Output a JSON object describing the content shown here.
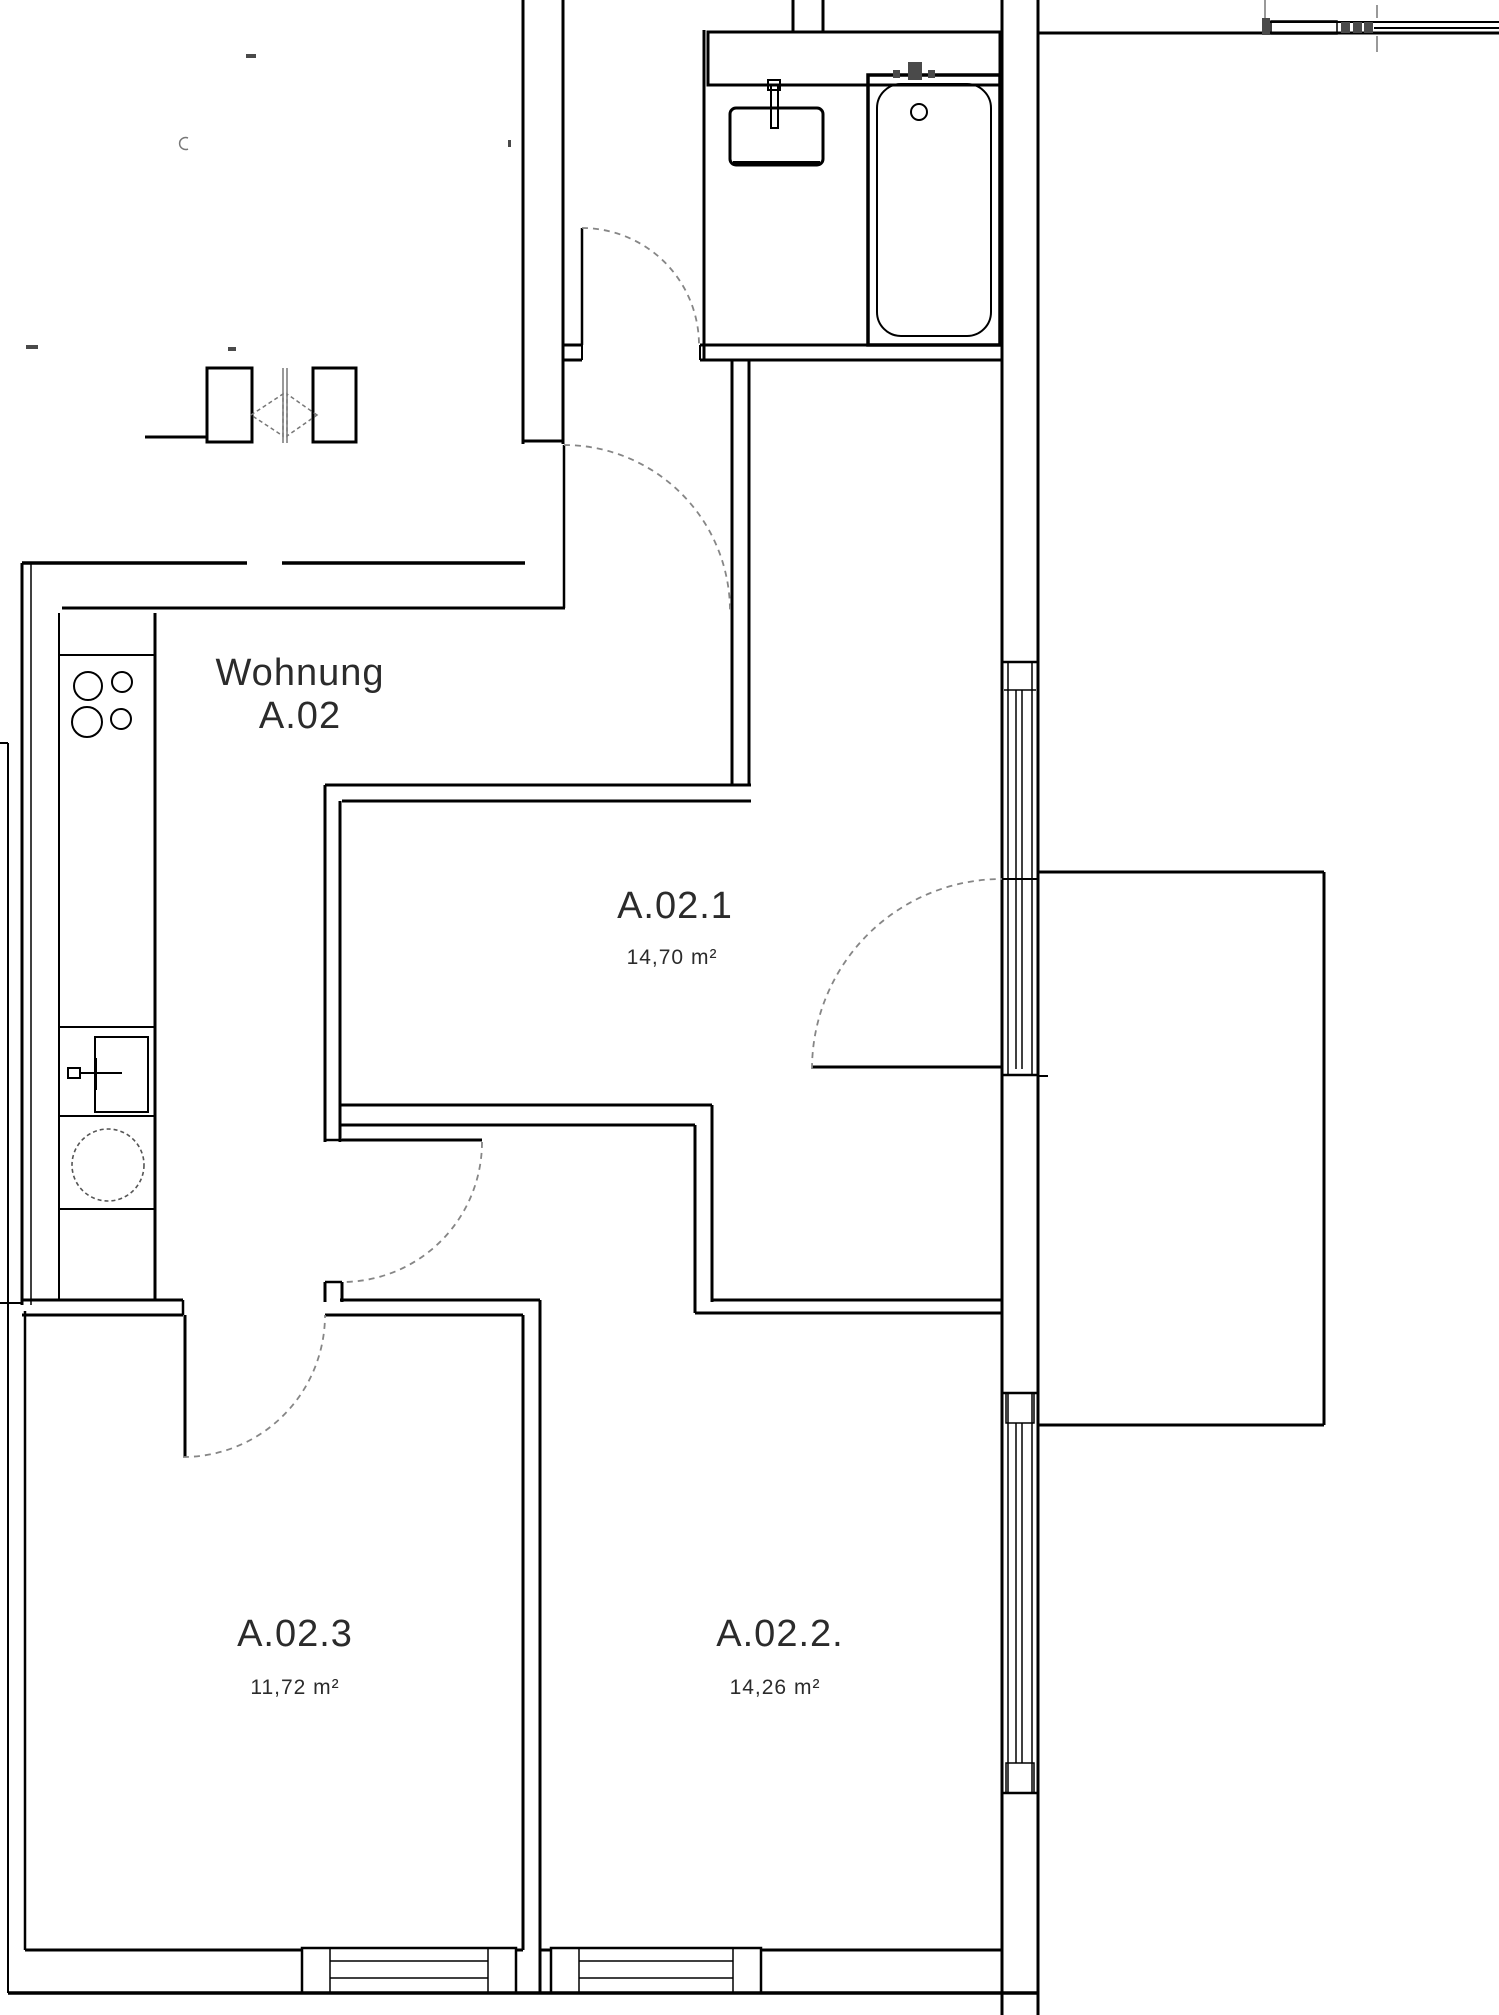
{
  "floor_plan": {
    "apartment_label": {
      "line1": "Wohnung",
      "line2": "A.02"
    },
    "rooms": [
      {
        "name": "A.02.1",
        "area": "14,70 m²"
      },
      {
        "name": "A.02.2.",
        "area": "14,26 m²"
      },
      {
        "name": "A.02.3",
        "area": "11,72 m²"
      }
    ],
    "colors": {
      "wall": "#000000",
      "label_text": "#2b2b2b",
      "door_arc": "#868686",
      "background": "#ffffff"
    }
  }
}
